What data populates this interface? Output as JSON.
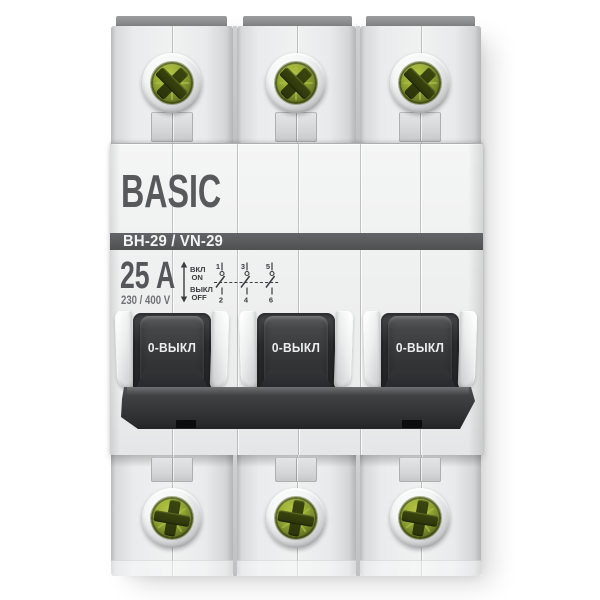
{
  "device": {
    "type_description": "3-pole modular switch disconnector, toggles in OFF position",
    "brand": "BASIC",
    "model": "ВН-29 / VN-29",
    "current_rating": "25 A",
    "voltage_rating": "230 / 400 V",
    "legend": {
      "on_ru": "ВКЛ",
      "on_en": "ON",
      "off_ru": "ВЫКЛ",
      "off_en": "OFF",
      "terminals_top": [
        "1",
        "3",
        "5"
      ],
      "terminals_bottom": [
        "2",
        "4",
        "6"
      ]
    },
    "toggles": [
      {
        "label": "0-ВЫКЛ",
        "state": "off"
      },
      {
        "label": "0-ВЫКЛ",
        "state": "off"
      },
      {
        "label": "0-ВЫКЛ",
        "state": "off"
      }
    ],
    "colors": {
      "model_band": "#58595b",
      "brand_text": "#58595b",
      "body_light": "#eceded",
      "fascia": "#eff0f0",
      "toggle_dark": "#323336",
      "tie_bar": "#2e2f31",
      "screw_green": "#7e9027",
      "screw_cross": "#323c0d",
      "screw_ring_metal": "#c6c7c9",
      "cap_gray": "#8c8d8f"
    }
  }
}
